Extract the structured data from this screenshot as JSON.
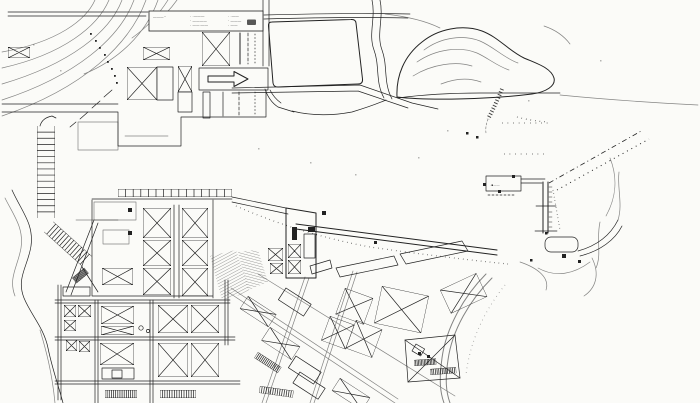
{
  "colors": {
    "paper": "#fbfbf8",
    "ink": "#222222",
    "legend_text": "#3a3a3a"
  },
  "legend": {
    "heading_marks": "―――··",
    "rows": [
      {
        "left": "· ·―――",
        "right": "· ·――"
      },
      {
        "left": "· ――――",
        "right": "· ―――"
      },
      {
        "left": "· ――·――",
        "right": "· ――"
      }
    ]
  },
  "pier_label": {
    "marks": "·▪――"
  },
  "icons": {
    "flow_arrow": "arrow-right"
  }
}
